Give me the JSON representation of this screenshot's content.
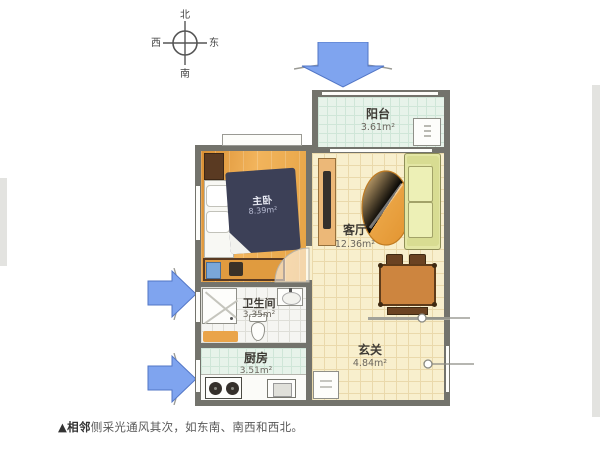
{
  "image_title": "apartment-floor-plan",
  "compass": {
    "north": "北",
    "south": "南",
    "east": "东",
    "west": "西"
  },
  "rooms": {
    "balcony": {
      "name": "阳台",
      "area": "3.61m²"
    },
    "master_bedroom": {
      "name": "主卧",
      "area": "8.39m²"
    },
    "living_room": {
      "name": "客厅",
      "area": "12.36m²"
    },
    "bathroom": {
      "name": "卫生间",
      "area": "3.35m²"
    },
    "kitchen": {
      "name": "厨房",
      "area": "3.51m²"
    },
    "foyer": {
      "name": "玄关",
      "area": "4.84m²"
    }
  },
  "caption": {
    "marker": "▲",
    "bold": "相邻",
    "rest": "侧采光通风其次，如东南、南西和西北。"
  },
  "colors": {
    "wall": "#73736c",
    "arrow_fill": "#7fa4ef",
    "arrow_stroke": "#5276c6",
    "wood_floor": "#e8a94e",
    "cream_floor": "#f8efcd",
    "mint_floor": "#e7f3ea",
    "bed": "#3c4057",
    "sofa": "#e3e6a4",
    "table": "#cd853f"
  }
}
